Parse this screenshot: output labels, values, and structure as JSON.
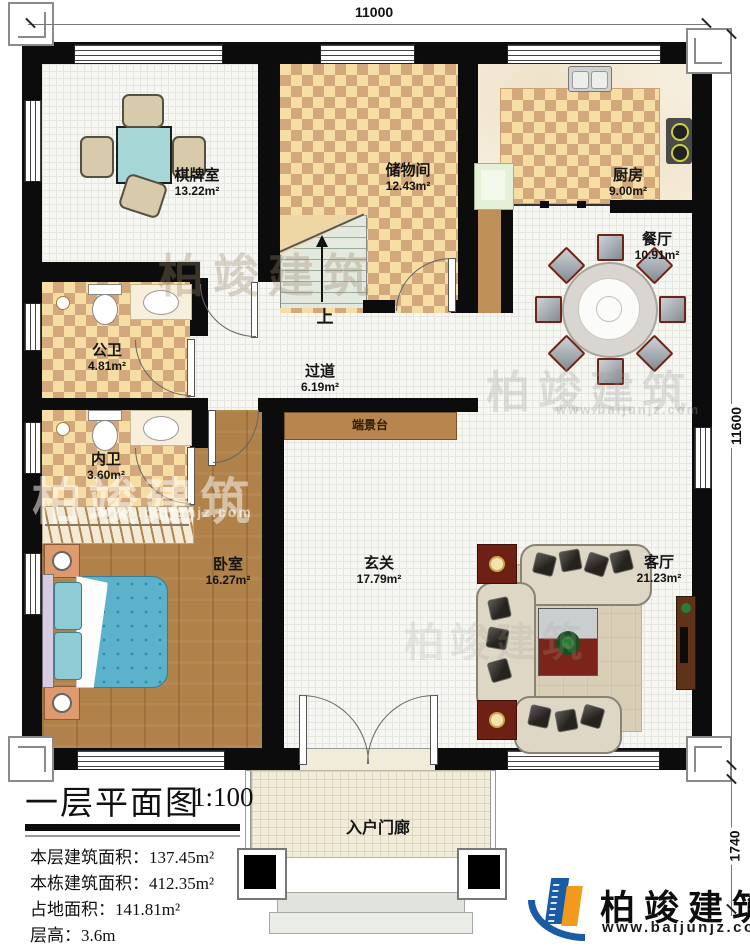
{
  "title_block": {
    "title": "一层平面图",
    "scale": "1:100"
  },
  "info_rows": [
    {
      "label": "本层建筑面积：",
      "value": "137.45m²"
    },
    {
      "label": "本栋建筑面积：",
      "value": "412.35m²"
    },
    {
      "label": "占地面积：",
      "value": "141.81m²"
    },
    {
      "label": "层高：",
      "value": "3.6m"
    }
  ],
  "dimensions": {
    "top": "11000",
    "right": "11600",
    "porch": "1740"
  },
  "rooms": {
    "qipai": {
      "name": "棋牌室",
      "area": "13.22m²"
    },
    "chuwu": {
      "name": "储物间",
      "area": "12.43m²"
    },
    "chufang": {
      "name": "厨房",
      "area": "9.00m²"
    },
    "canting": {
      "name": "餐厅",
      "area": "10.91m²"
    },
    "gongwei": {
      "name": "公卫",
      "area": "4.81m²"
    },
    "guodao": {
      "name": "过道",
      "area": "6.19m²"
    },
    "neiwei": {
      "name": "内卫",
      "area": "3.60m²"
    },
    "woshi": {
      "name": "卧室",
      "area": "16.27m²"
    },
    "xuanguan": {
      "name": "玄关",
      "area": "17.79m²"
    },
    "keting": {
      "name": "客厅",
      "area": "21.23m²"
    },
    "duanjingtai": {
      "name": "端景台"
    },
    "menlang": {
      "name": "入户门廊"
    }
  },
  "stairs": {
    "up_label": "上"
  },
  "brand": {
    "name": "柏竣建筑",
    "url": "www.baijunjz.com"
  },
  "watermark": {
    "text": "柏竣建筑",
    "url": "www.baijunjz.com"
  },
  "colors": {
    "wall": "#0c0c0c",
    "checker_light": "#f6dda4",
    "checker_dark": "#d2a87c",
    "wood": "#b08148",
    "table_teal": "#a7d6d6",
    "logo_blue": "#1a5ba6",
    "logo_orange": "#f29a1d"
  }
}
